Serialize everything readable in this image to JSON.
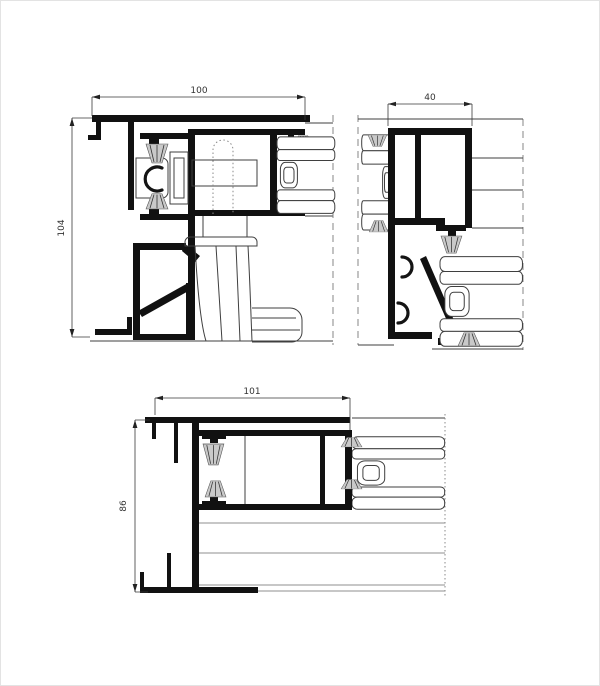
{
  "drawing": {
    "kind": "aluminium sliding system profile cross-sections",
    "style": {
      "background": "#ffffff",
      "profile_color": "#111111",
      "thin_line_color": "#3f3f3f",
      "dimension_color": "#3a3a3a",
      "panel_line_color": "#8f8f8f",
      "brush_fill": "#c9c9c9"
    },
    "views": {
      "frame_section": {
        "width_dim": "100",
        "height_dim": "104"
      },
      "jamb_section": {
        "width_dim": "40"
      },
      "sill_section": {
        "width_dim": "101",
        "height_dim": "86"
      }
    }
  }
}
